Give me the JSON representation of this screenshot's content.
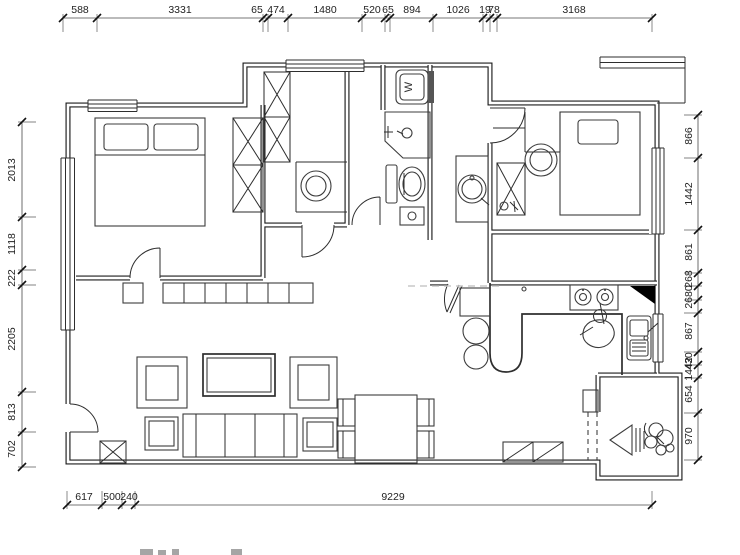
{
  "page": {
    "background": "#ffffff",
    "kind": "apartment floor plan"
  },
  "colors": {
    "wall": "#1c1c1c",
    "line": "#3c3c3c",
    "dim_text": "#222222",
    "corner_fill": "#000000",
    "watermark": "#c8c8c8"
  },
  "fixtures": {
    "washing_machine_label": "W"
  },
  "dimensions": {
    "top": {
      "orientation": "h",
      "line_pos": 18,
      "label_pos": 10,
      "ticks": [
        63,
        97,
        263,
        268,
        288,
        362,
        385,
        390,
        433,
        483,
        490,
        497,
        652
      ],
      "labels": [
        {
          "t": "588",
          "p": 80
        },
        {
          "t": "3331",
          "p": 180
        },
        {
          "t": "65",
          "p": 257
        },
        {
          "t": "474",
          "p": 276
        },
        {
          "t": "1480",
          "p": 325
        },
        {
          "t": "520",
          "p": 372
        },
        {
          "t": "65",
          "p": 388
        },
        {
          "t": "894",
          "p": 412
        },
        {
          "t": "1026",
          "p": 458
        },
        {
          "t": "19",
          "p": 485
        },
        {
          "t": "78",
          "p": 494
        },
        {
          "t": "3168",
          "p": 574
        }
      ]
    },
    "bottom": {
      "orientation": "h",
      "line_pos": 505,
      "label_pos": 497,
      "ticks": [
        67,
        102,
        122,
        135,
        652
      ],
      "labels": [
        {
          "t": "617",
          "p": 84
        },
        {
          "t": "500",
          "p": 112
        },
        {
          "t": "240",
          "p": 129
        },
        {
          "t": "9229",
          "p": 393
        }
      ]
    },
    "left": {
      "orientation": "v",
      "line_pos": 22,
      "label_pos": 12,
      "ticks": [
        122,
        217,
        270,
        285,
        392,
        432,
        467
      ],
      "labels": [
        {
          "t": "2013",
          "p": 170
        },
        {
          "t": "1118",
          "p": 244
        },
        {
          "t": "222",
          "p": 278
        },
        {
          "t": "2205",
          "p": 339
        },
        {
          "t": "813",
          "p": 412
        },
        {
          "t": "702",
          "p": 449
        }
      ]
    },
    "right": {
      "orientation": "v",
      "line_pos": 698,
      "label_pos": 689,
      "ticks": [
        115,
        158,
        230,
        273,
        286,
        300,
        313,
        352,
        365,
        378,
        413,
        460
      ],
      "labels": [
        {
          "t": "866",
          "p": 136
        },
        {
          "t": "1442",
          "p": 194
        },
        {
          "t": "861",
          "p": 252
        },
        {
          "t": "268",
          "p": 279
        },
        {
          "t": "2680",
          "p": 297
        },
        {
          "t": "867",
          "p": 331
        },
        {
          "t": "430",
          "p": 361
        },
        {
          "t": "1442",
          "p": 369
        },
        {
          "t": "654",
          "p": 394
        },
        {
          "t": "970",
          "p": 436
        }
      ]
    }
  }
}
